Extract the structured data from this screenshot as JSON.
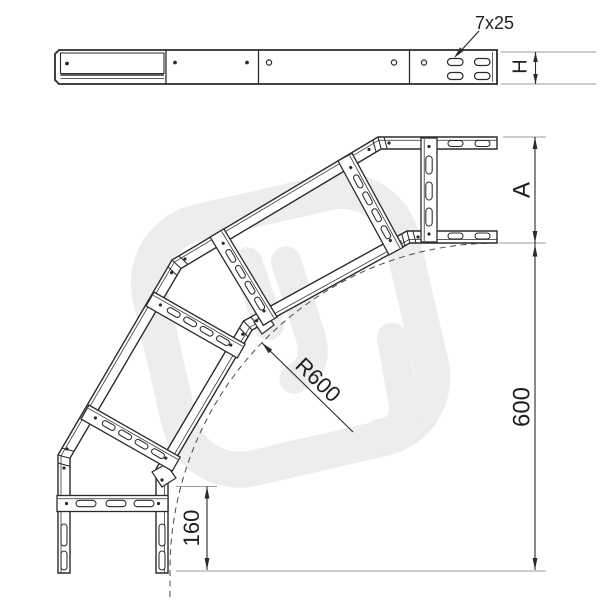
{
  "drawing": {
    "type": "cable-ladder-90-degree-bend-technical-drawing",
    "labels": {
      "slot_size": "7x25",
      "side_height": "H",
      "width": "A",
      "radius": "R600",
      "overall_length": "600",
      "end_tangent": "160"
    },
    "colors": {
      "line": "#2b2b2b",
      "extension_line": "#9b9b9b",
      "dashed_arc": "#4a4a4a",
      "watermark": "#ededed",
      "background": "#ffffff"
    }
  }
}
